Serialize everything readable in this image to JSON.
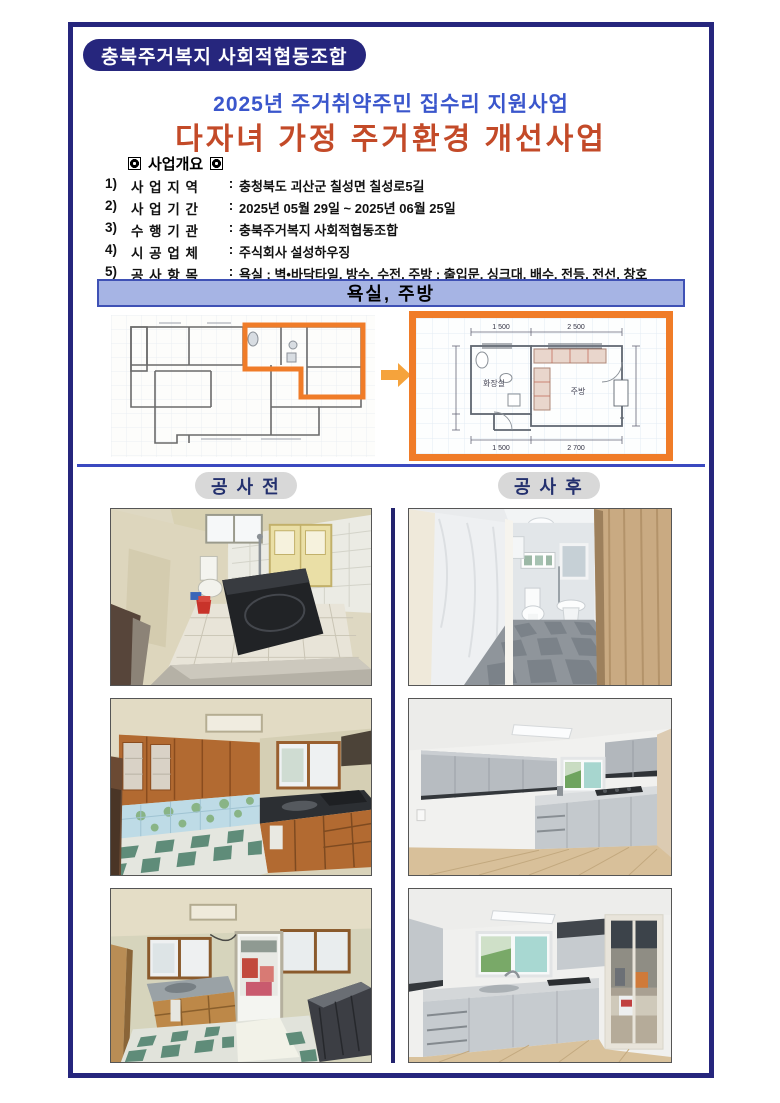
{
  "header": {
    "org_badge": "충북주거복지 사회적협동조합",
    "subtitle": "2025년 주거취약주민 집수리 지원사업",
    "main_title": "다자녀 가정 주거환경 개선사업"
  },
  "colors": {
    "frame_border": "#26267d",
    "subtitle_blue": "#3a56cc",
    "title_red": "#c34a28",
    "banner_bg": "#a6b4e4",
    "banner_border": "#3f51b5",
    "highlight_orange": "#f07c28",
    "pill_bg": "#d8d8d8",
    "pill_text": "#23306e",
    "divider_navy": "#3b49c0"
  },
  "overview": {
    "heading": "사업개요",
    "items": [
      {
        "no": "1)",
        "label": "사 업 지 역",
        "sep": ":",
        "value": "충청북도 괴산군 칠성면 칠성로5길"
      },
      {
        "no": "2)",
        "label": "사 업 기 간",
        "sep": ":",
        "value": "2025년 05월 29일 ~ 2025년 06월 25일"
      },
      {
        "no": "3)",
        "label": "수 행 기 관",
        "sep": ":",
        "value": "충북주거복지 사회적협동조합"
      },
      {
        "no": "4)",
        "label": "시 공 업 체",
        "sep": ":",
        "value": "주식회사 설성하우징"
      },
      {
        "no": "5)",
        "label": "공 사 항 목",
        "sep": ":",
        "value": "욕실 : 벽•바닥타일, 방수, 수전,  주방 : 출입문, 싱크대, 배수, 전등, 전선, 창호"
      }
    ]
  },
  "banner": {
    "label": "욕실, 주방"
  },
  "floorplan": {
    "rooms": {
      "bathroom": "화장실",
      "kitchen": "주방"
    },
    "dims": {
      "top_left": "1 500",
      "top_right": "2 500",
      "bottom_left": "1 500",
      "bottom_right": "2 700"
    }
  },
  "comparison": {
    "before_label": "공 사 전",
    "after_label": "공 사 후",
    "photos": {
      "before": [
        "before-bathroom-photo",
        "before-kitchen-photo",
        "before-kitchen-2-photo"
      ],
      "after": [
        "after-bathroom-photo",
        "after-kitchen-photo",
        "after-kitchen-2-photo"
      ]
    }
  }
}
